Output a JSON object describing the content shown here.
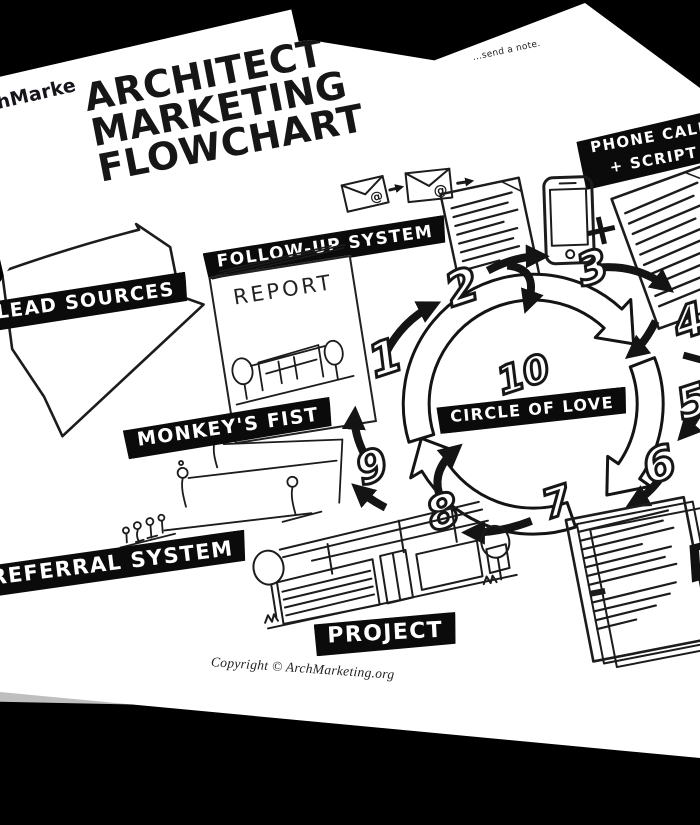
{
  "scene": {
    "background": "#000000",
    "paper": "#ffffff",
    "ink": "#161616",
    "accent_blue": "#4a90c4"
  },
  "back_page": {
    "brand_fragment": "ArchMarke",
    "tiny_text_fragment": "enti",
    "note_fragment": "...send a note."
  },
  "front_page": {
    "title_line1": "ARCHITECT",
    "title_line2": "MARKETING",
    "title_line3": "FLOWCHART",
    "labels": {
      "follow_up": "FOLLOW-UP SYSTEM",
      "phone_call_line1": "PHONE CALL",
      "phone_call_line2": "+ SCRIPT",
      "lead_sources": "LEAD SOURCES",
      "monkeys_fist": "MONKEY'S FIST",
      "circle_of_love": "CIRCLE OF LOVE",
      "referral_system": "REFERRAL SYSTEM",
      "project": "PROJECT"
    },
    "report_cover_title": "REPORT",
    "steps": [
      "1",
      "2",
      "3",
      "4",
      "5",
      "6",
      "7",
      "8",
      "9",
      "10"
    ],
    "envelope_symbol": "@",
    "plus_symbol": "+",
    "partial_label_fragment": "D",
    "copyright": "Copyright © ArchMarketing.org"
  }
}
